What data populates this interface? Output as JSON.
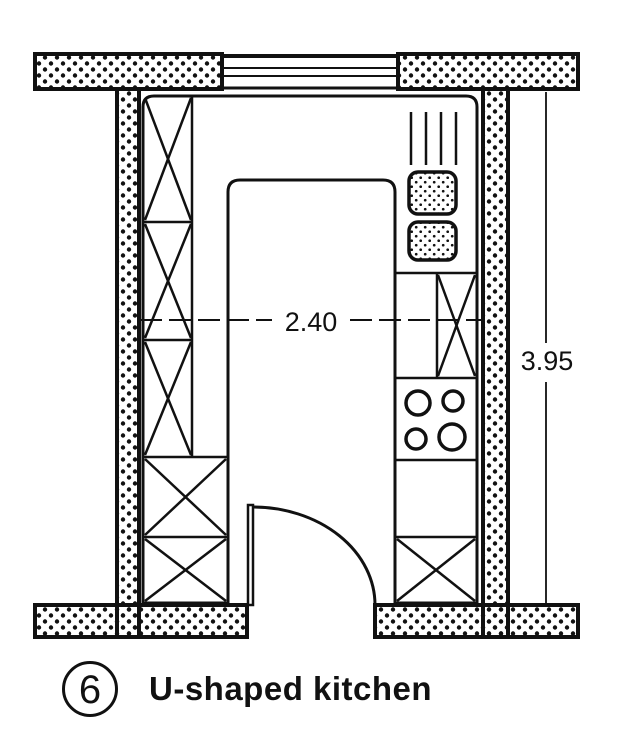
{
  "figure": {
    "number": "6",
    "caption": "U-shaped kitchen"
  },
  "dimensions": {
    "width": "2.40",
    "height": "3.95"
  },
  "colors": {
    "ink": "#111111",
    "paper": "#ffffff"
  },
  "plan_symbols": [
    "window",
    "door-swing",
    "tall-cabinet-x",
    "corner-base-cabinet-x",
    "drainer-hatch",
    "double-sink-basins",
    "cooktop-four-burners",
    "base-cabinet-x"
  ]
}
